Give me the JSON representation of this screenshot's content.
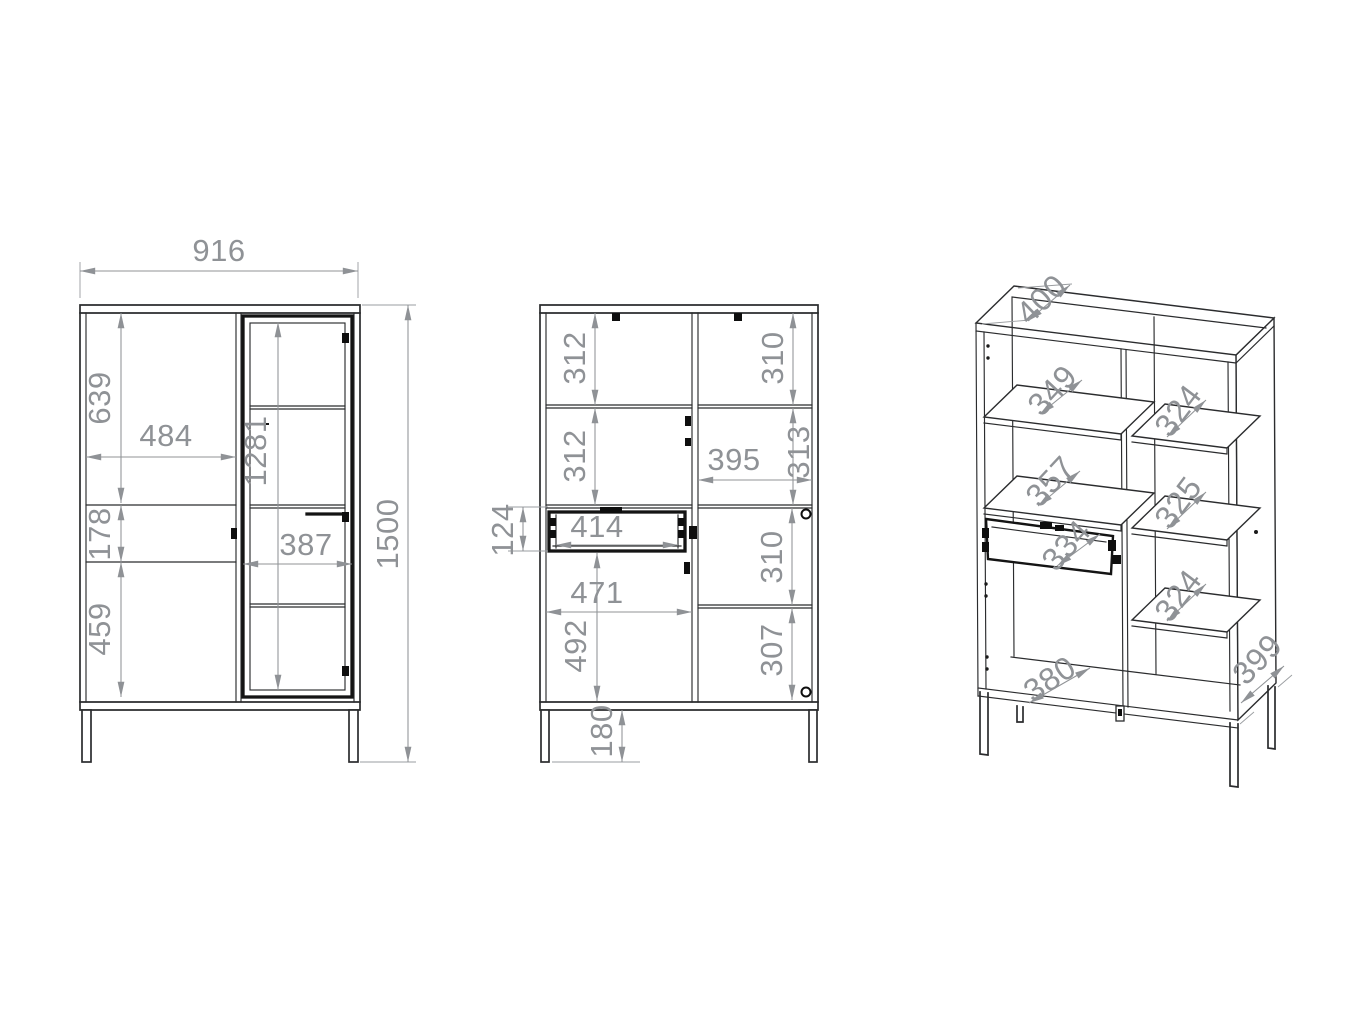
{
  "document": {
    "kind": "furniture-technical-drawing",
    "subject": "display cabinet (vitrine) with metal legs - dimensioned drawing, three views",
    "units": "mm",
    "background": "#ffffff"
  },
  "colors": {
    "object_line": "#2b2c2e",
    "accent_black": "#141414",
    "dimension_gray": "#8f9296",
    "background": "#ffffff"
  },
  "views": {
    "front": {
      "name": "front-exterior-view",
      "overall_width": "916",
      "overall_height": "1500",
      "dims": [
        {
          "label": "916",
          "x": 219,
          "y": 253,
          "rot": 0,
          "size": 31
        },
        {
          "label": "639",
          "x": 102,
          "y": 398,
          "rot": -90,
          "size": 31
        },
        {
          "label": "484",
          "x": 166,
          "y": 438,
          "rot": 0,
          "size": 31
        },
        {
          "label": "1281",
          "x": 258,
          "y": 451,
          "rot": -90,
          "size": 31
        },
        {
          "label": "178",
          "x": 102,
          "y": 534,
          "rot": -90,
          "size": 31
        },
        {
          "label": "387",
          "x": 306,
          "y": 547,
          "rot": 0,
          "size": 31
        },
        {
          "label": "459",
          "x": 102,
          "y": 629,
          "rot": -90,
          "size": 31
        },
        {
          "label": "1500",
          "x": 390,
          "y": 534,
          "rot": -90,
          "size": 31
        }
      ]
    },
    "section": {
      "name": "front-internal-view",
      "dims": [
        {
          "label": "312",
          "x": 577,
          "y": 358,
          "rot": -90,
          "size": 31
        },
        {
          "label": "312",
          "x": 577,
          "y": 456,
          "rot": -90,
          "size": 31
        },
        {
          "label": "310",
          "x": 775,
          "y": 358,
          "rot": -90,
          "size": 31
        },
        {
          "label": "313",
          "x": 801,
          "y": 452,
          "rot": -90,
          "size": 31
        },
        {
          "label": "395",
          "x": 734,
          "y": 462,
          "rot": 0,
          "size": 31
        },
        {
          "label": "124",
          "x": 505,
          "y": 530,
          "rot": -90,
          "size": 31
        },
        {
          "label": "414",
          "x": 597,
          "y": 529,
          "rot": 0,
          "size": 31
        },
        {
          "label": "471",
          "x": 597,
          "y": 595,
          "rot": 0,
          "size": 31
        },
        {
          "label": "492",
          "x": 578,
          "y": 646,
          "rot": -90,
          "size": 31
        },
        {
          "label": "310",
          "x": 774,
          "y": 557,
          "rot": -90,
          "size": 31
        },
        {
          "label": "307",
          "x": 774,
          "y": 650,
          "rot": -90,
          "size": 31
        },
        {
          "label": "180",
          "x": 604,
          "y": 731,
          "rot": -90,
          "size": 31
        }
      ]
    },
    "perspective": {
      "name": "perspective-open-view",
      "dims": [
        {
          "label": "400",
          "x": 1043,
          "y": 301,
          "rot": -44,
          "size": 32
        },
        {
          "label": "349",
          "x": 1054,
          "y": 392,
          "rot": -47,
          "size": 32
        },
        {
          "label": "324",
          "x": 1180,
          "y": 412,
          "rot": -53,
          "size": 32
        },
        {
          "label": "357",
          "x": 1052,
          "y": 483,
          "rot": -47,
          "size": 32
        },
        {
          "label": "325",
          "x": 1180,
          "y": 504,
          "rot": -53,
          "size": 32
        },
        {
          "label": "334",
          "x": 1068,
          "y": 547,
          "rot": -48,
          "size": 32
        },
        {
          "label": "324",
          "x": 1180,
          "y": 597,
          "rot": -53,
          "size": 32
        },
        {
          "label": "380",
          "x": 1051,
          "y": 681,
          "rot": -34,
          "size": 32
        },
        {
          "label": "399",
          "x": 1259,
          "y": 661,
          "rot": -46,
          "size": 32
        }
      ]
    }
  }
}
